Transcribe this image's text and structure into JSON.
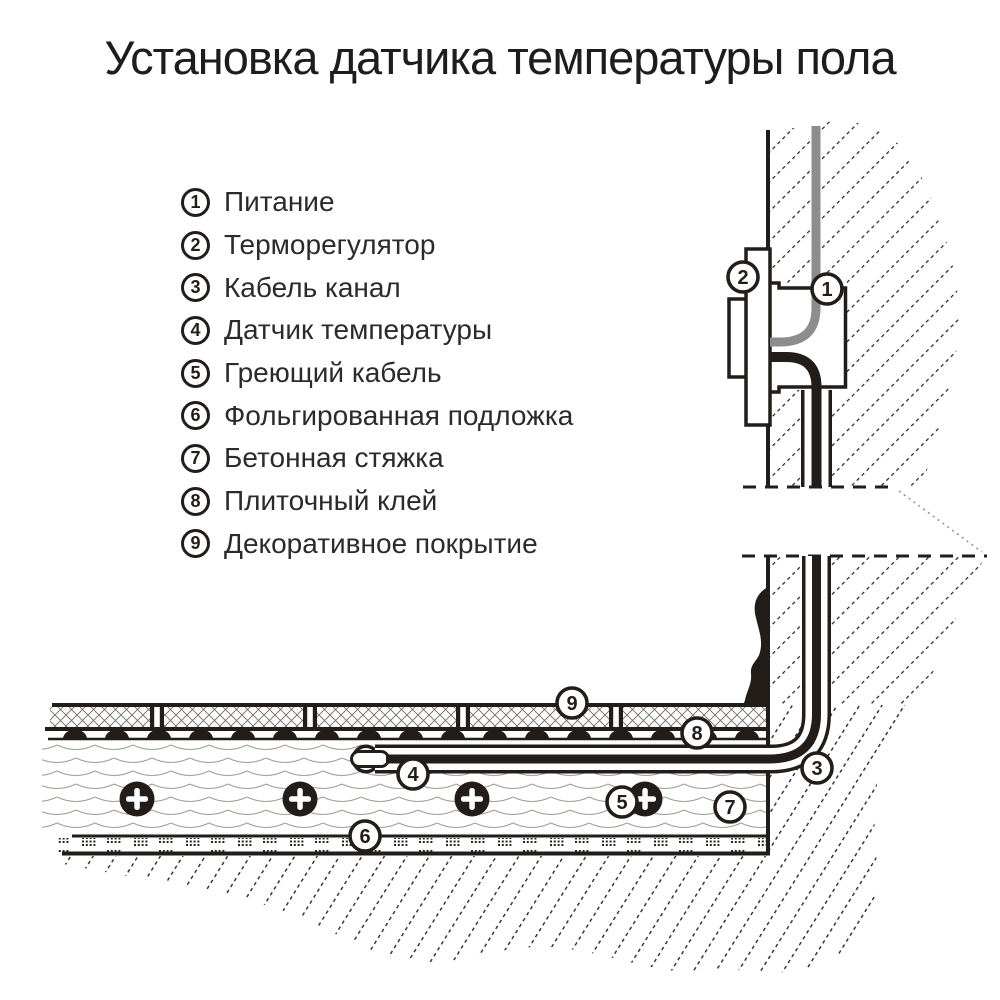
{
  "page": {
    "title": "Установка датчика температуры пола",
    "background": "#ffffff"
  },
  "legend": {
    "items": [
      {
        "num": "1",
        "label": "Питание"
      },
      {
        "num": "2",
        "label": "Терморегулятор"
      },
      {
        "num": "3",
        "label": "Кабель канал"
      },
      {
        "num": "4",
        "label": "Датчик температуры"
      },
      {
        "num": "5",
        "label": "Греющий кабель"
      },
      {
        "num": "6",
        "label": "Фольгированная подложка"
      },
      {
        "num": "7",
        "label": "Бетонная стяжка"
      },
      {
        "num": "8",
        "label": "Плиточный клей"
      },
      {
        "num": "9",
        "label": "Декоративное покрытие"
      }
    ]
  },
  "diagram": {
    "markers": [
      "1",
      "2",
      "3",
      "4",
      "5",
      "6",
      "7",
      "8",
      "9"
    ],
    "colors": {
      "ink": "#221d18",
      "hatch": "#2b2620",
      "power_cable_gray": "#8d8d8d",
      "wave_line": "#a39f97",
      "paper": "#ffffff"
    }
  }
}
